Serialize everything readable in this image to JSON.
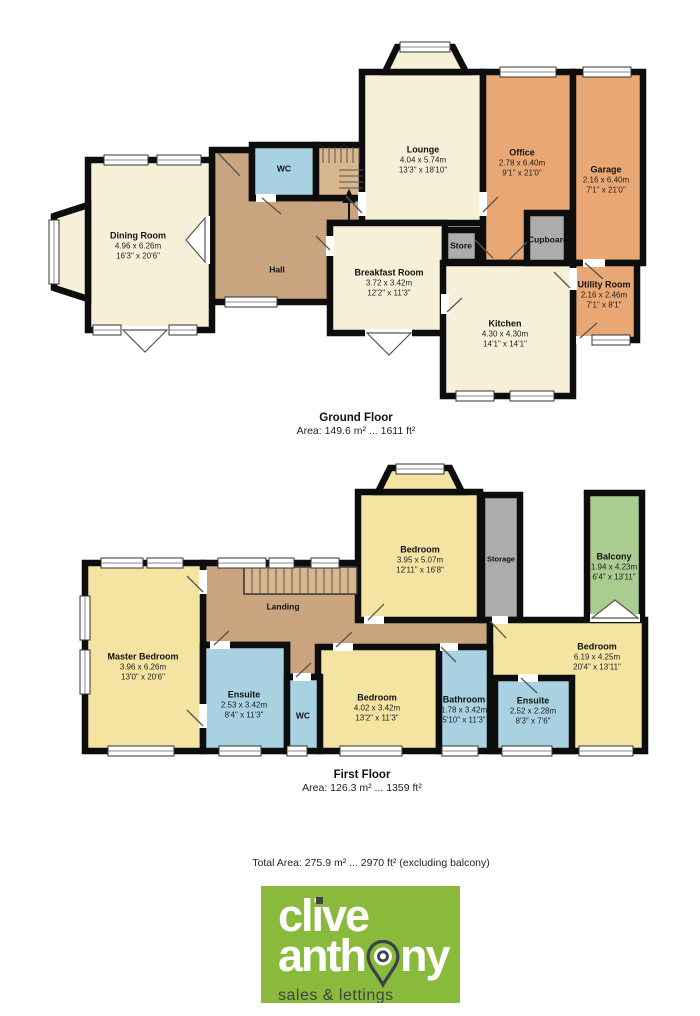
{
  "floors": [
    {
      "name": "Ground Floor",
      "area": "Area: 149.6 m² ... 1611 ft²",
      "rooms": [
        {
          "id": "dining-room",
          "name": "Dining Room",
          "dim_m": "4.96 x 6.26m",
          "dim_ft": "16'3\" x 20'6\""
        },
        {
          "id": "hall",
          "name": "Hall"
        },
        {
          "id": "wc",
          "name": "WC"
        },
        {
          "id": "lounge",
          "name": "Lounge",
          "dim_m": "4.04 x 5.74m",
          "dim_ft": "13'3\" x 18'10\""
        },
        {
          "id": "office",
          "name": "Office",
          "dim_m": "2.78 x 6.40m",
          "dim_ft": "9'1\" x 21'0\""
        },
        {
          "id": "garage",
          "name": "Garage",
          "dim_m": "2.16 x 6.40m",
          "dim_ft": "7'1\" x 21'0\""
        },
        {
          "id": "store",
          "name": "Store"
        },
        {
          "id": "cupboard",
          "name": "Cupboard"
        },
        {
          "id": "breakfast-room",
          "name": "Breakfast Room",
          "dim_m": "3.72 x 3.42m",
          "dim_ft": "12'2\" x 11'3\""
        },
        {
          "id": "kitchen",
          "name": "Kitchen",
          "dim_m": "4.30 x 4.30m",
          "dim_ft": "14'1\" x 14'1\""
        },
        {
          "id": "utility-room",
          "name": "Utility Room",
          "dim_m": "2.16 x 2.46m",
          "dim_ft": "7'1\" x 8'1\""
        }
      ]
    },
    {
      "name": "First Floor",
      "area": "Area: 126.3 m² ... 1359 ft²",
      "rooms": [
        {
          "id": "master-bedroom",
          "name": "Master Bedroom",
          "dim_m": "3.96 x 6.26m",
          "dim_ft": "13'0\" x 20'6\""
        },
        {
          "id": "landing",
          "name": "Landing"
        },
        {
          "id": "ensuite-1",
          "name": "Ensuite",
          "dim_m": "2.53 x 3.42m",
          "dim_ft": "8'4\" x 11'3\""
        },
        {
          "id": "wc-first",
          "name": "WC"
        },
        {
          "id": "bedroom-front",
          "name": "Bedroom",
          "dim_m": "3.95 x 5.07m",
          "dim_ft": "12'11\" x 16'8\""
        },
        {
          "id": "storage",
          "name": "Storage"
        },
        {
          "id": "balcony",
          "name": "Balcony",
          "dim_m": "1.94 x 4.23m",
          "dim_ft": "6'4\" x 13'11\""
        },
        {
          "id": "bedroom-right",
          "name": "Bedroom",
          "dim_m": "6.19 x 4.25m",
          "dim_ft": "20'4\" x 13'11\""
        },
        {
          "id": "bedroom-middle",
          "name": "Bedroom",
          "dim_m": "4.02 x 3.42m",
          "dim_ft": "13'2\" x 11'3\""
        },
        {
          "id": "bathroom",
          "name": "Bathroom",
          "dim_m": "1.78 x 3.42m",
          "dim_ft": "5'10\" x 11'3\""
        },
        {
          "id": "ensuite-2",
          "name": "Ensuite",
          "dim_m": "2.52 x 2.28m",
          "dim_ft": "8'3\" x 7'6\""
        }
      ]
    }
  ],
  "total_area": "Total Area: 275.9 m² ... 2970 ft² (excluding balcony)",
  "logo": {
    "word1": "clive",
    "word2_pre": "anth",
    "word2_post": "ny",
    "tagline": "sales & lettings"
  },
  "colors": {
    "cream": "#F6F0D9",
    "tan": "#C9A47E",
    "stair_tan": "#D8B78F",
    "orange": "#E9A873",
    "blue": "#A8D2E1",
    "yellow": "#F4E3A1",
    "green": "#A9CD90",
    "gray": "#ACACAC",
    "wall": "#0D0D0D",
    "logo_green": "#8ABA3B",
    "logo_dark": "#3E4347"
  }
}
